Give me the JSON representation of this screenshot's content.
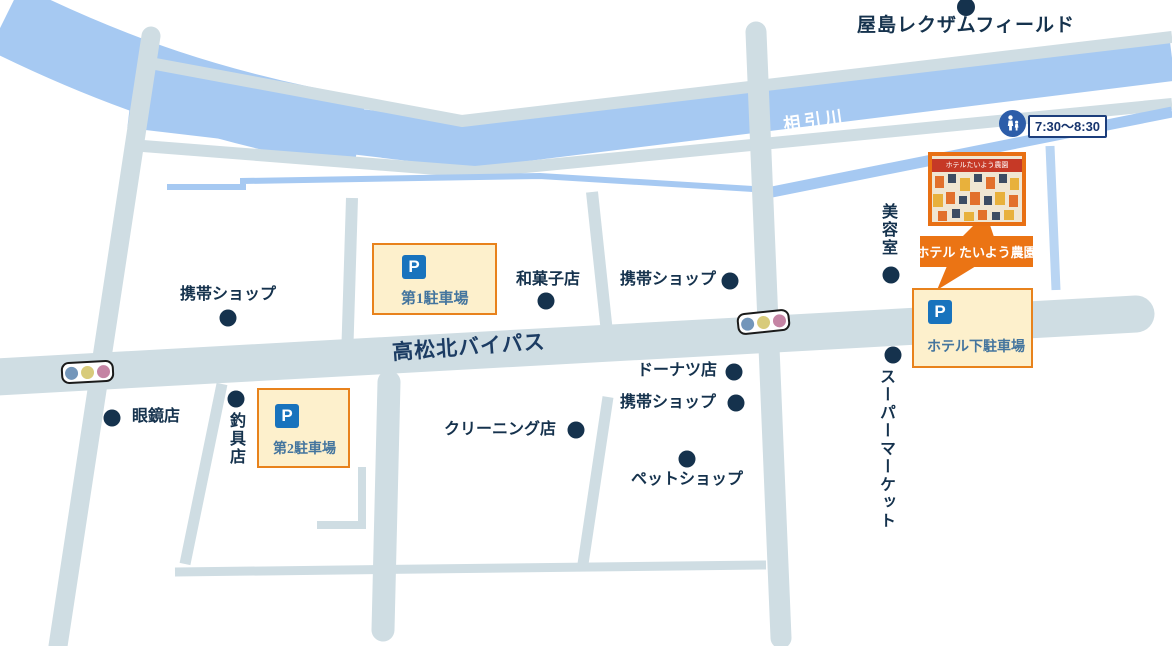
{
  "landmark": {
    "label": "屋島レクザムフィールド"
  },
  "river": {
    "name": "相引川"
  },
  "bypass": {
    "name": "高松北バイパス"
  },
  "school_zone": {
    "time": "7:30〜8:30"
  },
  "hotel": {
    "callout_label": "ホテル たいよう農園",
    "photo_sign": "ホテルたいよう農園"
  },
  "parking_lots": [
    {
      "icon": "P",
      "label": "第1駐車場"
    },
    {
      "icon": "P",
      "label": "第2駐車場"
    },
    {
      "icon": "P",
      "label": "ホテル下駐車場"
    }
  ],
  "shops": [
    {
      "name": "携帯ショップ"
    },
    {
      "name": "和菓子店"
    },
    {
      "name": "携帯ショップ"
    },
    {
      "name": "ドーナツ店"
    },
    {
      "name": "携帯ショップ"
    },
    {
      "name": "クリーニング店"
    },
    {
      "name": "ペットショップ"
    },
    {
      "name": "眼鏡店"
    },
    {
      "name": "釣具店"
    },
    {
      "name": "美容室"
    },
    {
      "name": "スーパーマーケット"
    }
  ],
  "colors": {
    "river": "#a6c9f2",
    "road": "#cfdde3",
    "accent_orange": "#eb7414",
    "navy": "#15324d",
    "parking_bg": "#fdf0cc",
    "p_icon_blue": "#1873bd"
  }
}
